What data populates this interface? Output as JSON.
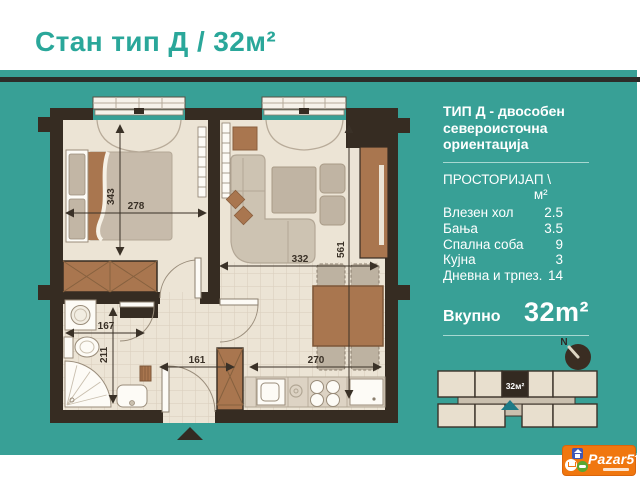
{
  "title": "Стан тип Д / 32м²",
  "panel": {
    "heading_lines": [
      "ТИП Д - двособен",
      "североисточна",
      "ориентација"
    ],
    "table": {
      "header": {
        "name": "ПРОСТОРИЈА",
        "value": "П \\ м²"
      },
      "rows": [
        {
          "name": "Влезен хол",
          "value": "2.5"
        },
        {
          "name": "Бања",
          "value": "3.5"
        },
        {
          "name": "Спална соба",
          "value": "9"
        },
        {
          "name": "Кујна",
          "value": "3"
        },
        {
          "name": "Дневна и трпез.",
          "value": "14"
        }
      ]
    },
    "total": {
      "label": "Вкупно",
      "value": "32m²"
    }
  },
  "floorplan": {
    "dims": {
      "bedroom_h": "343",
      "bedroom_w": "278",
      "living_h": "561",
      "living_w": "332",
      "bath_w": "167",
      "bath_h": "211",
      "hall_w": "161",
      "kitchen_w": "270"
    }
  },
  "compass": {
    "label": "N"
  },
  "building_section": {
    "unit_label": "32м²"
  },
  "logo": {
    "brand": "Pazar5",
    "tld": ".mk"
  },
  "colors": {
    "teal_panel": "#38a096",
    "title_teal": "#2aa79a",
    "wall_dark": "#362c22",
    "floor_beige": "#ece4d5",
    "furniture_brown": "#a9764f",
    "logo_orange": "#f0770f"
  }
}
